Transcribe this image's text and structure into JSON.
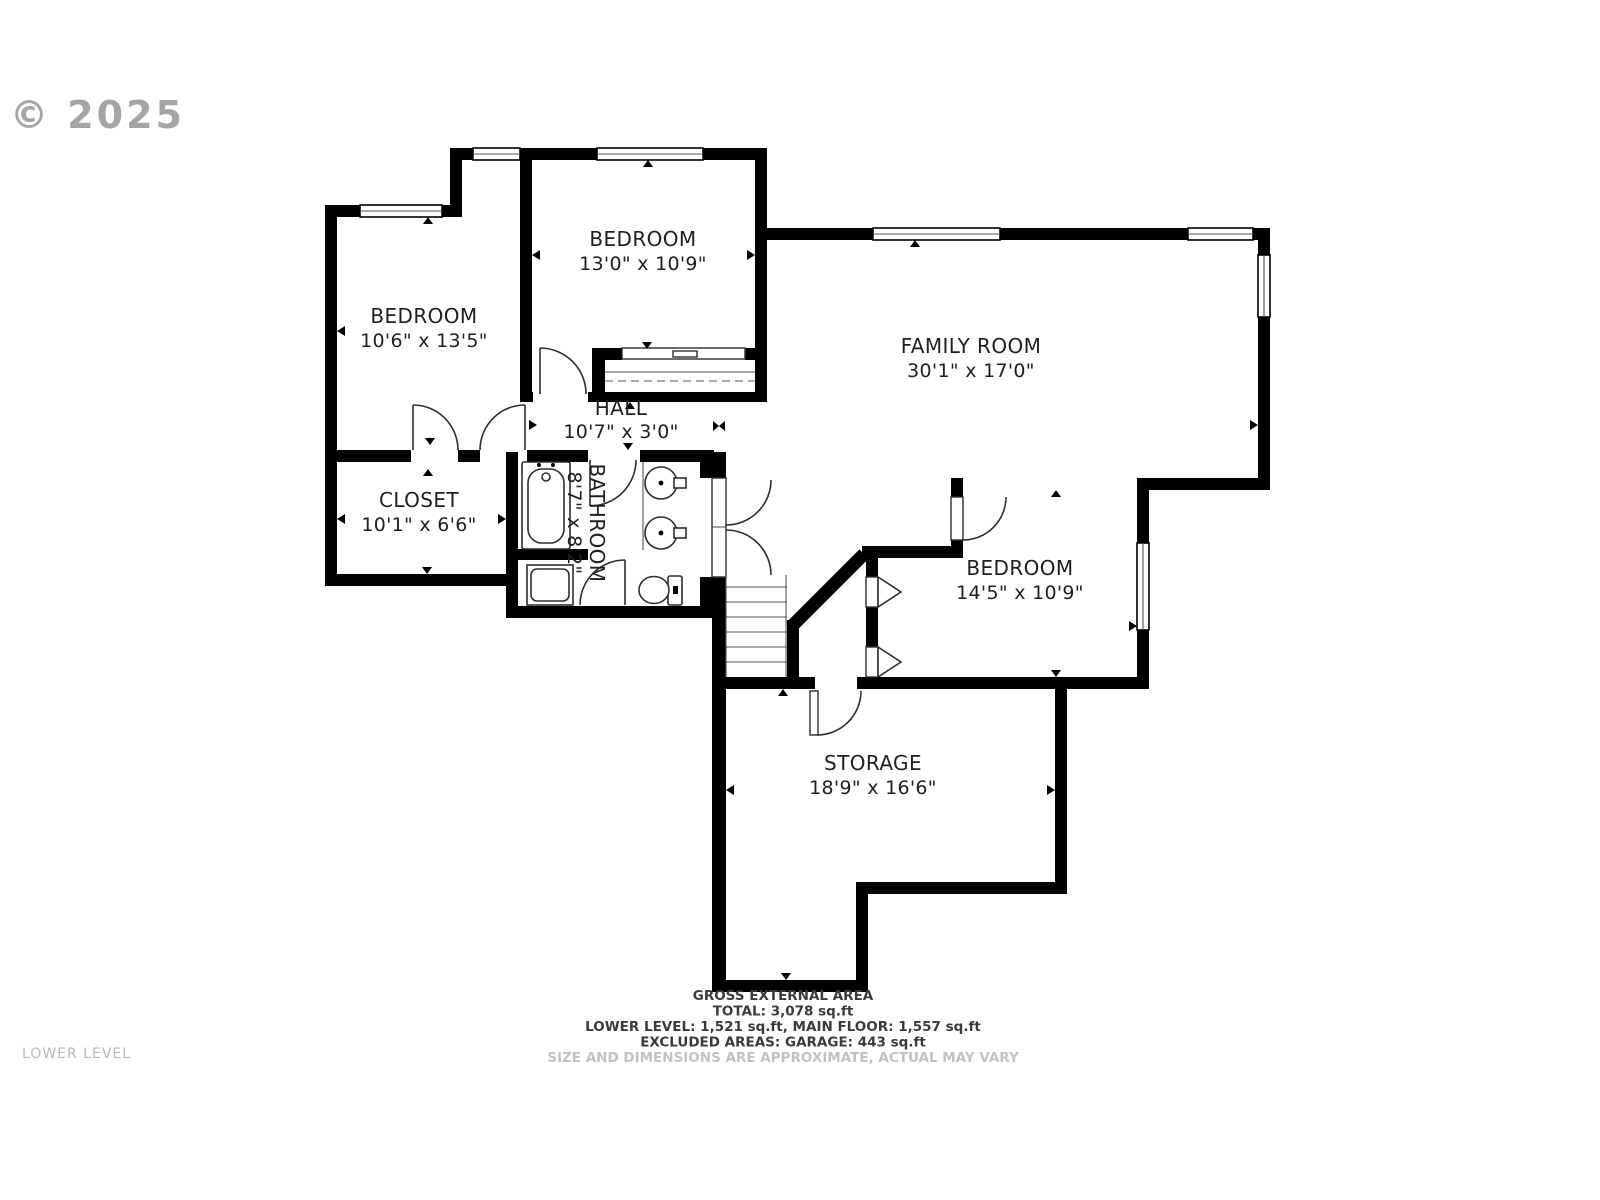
{
  "watermark": {
    "copyright": "© 2025"
  },
  "plan_level_label": "LOWER LEVEL",
  "rooms": [
    {
      "id": "bedroom-top",
      "name": "BEDROOM",
      "dims": "13'0\" x 10'9\""
    },
    {
      "id": "bedroom-left",
      "name": "BEDROOM",
      "dims": "10'6\" x 13'5\""
    },
    {
      "id": "family-room",
      "name": "FAMILY ROOM",
      "dims": "30'1\" x 17'0\""
    },
    {
      "id": "hall",
      "name": "HALL",
      "dims": "10'7\" x 3'0\""
    },
    {
      "id": "closet",
      "name": "CLOSET",
      "dims": "10'1\" x 6'6\""
    },
    {
      "id": "bathroom",
      "name": "BATHROOM",
      "dims": "8'7\" x 8'2\""
    },
    {
      "id": "bedroom-right",
      "name": "BEDROOM",
      "dims": "14'5\" x 10'9\""
    },
    {
      "id": "storage",
      "name": "STORAGE",
      "dims": "18'9\" x 16'6\""
    }
  ],
  "footer": {
    "line1": "GROSS EXTERNAL AREA",
    "line2": "TOTAL: 3,078 sq.ft",
    "line3": "LOWER LEVEL: 1,521 sq.ft, MAIN FLOOR: 1,557 sq.ft",
    "line4": "EXCLUDED AREAS: GARAGE: 443 sq.ft",
    "disclaimer": "SIZE AND DIMENSIONS ARE APPROXIMATE, ACTUAL MAY VARY"
  },
  "colors": {
    "wall": "#000000",
    "line": "#2e2e2e",
    "text": "#1f1f1f",
    "muted": "#b9b9b9",
    "watermark": "#8f8f8f"
  }
}
